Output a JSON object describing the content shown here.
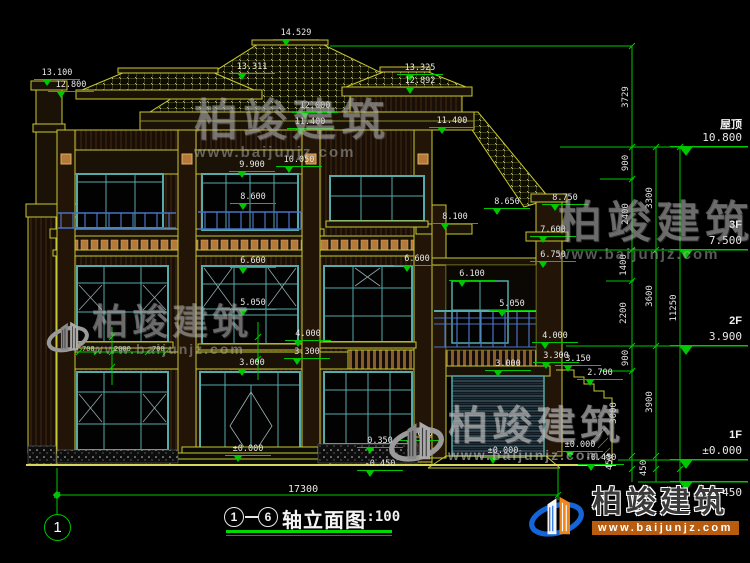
{
  "drawing": {
    "axis_start": "1",
    "axis_end": "6",
    "title": "轴立面图",
    "scale": "1:100",
    "axis_bubble": "1",
    "overall_width_dim": "17300"
  },
  "watermark": {
    "text": "柏竣建筑",
    "url": "www.baijunjz.com"
  },
  "brand": {
    "name": "柏竣建筑",
    "url": "www.baijunjz.com"
  },
  "colors": {
    "background": "#000000",
    "dim_line": "#00c800",
    "dim_text": "#e8e8e8",
    "wall_line": "#c8c832",
    "window_frame": "#55aaaa",
    "railing": "#4a72c4",
    "accent": "#b5793a",
    "brand_blue": "#1565d8",
    "brand_orange": "#f08519"
  },
  "annotations": {
    "spot_markers": [
      {
        "v": "14.529",
        "x": 296,
        "y": 33
      },
      {
        "v": "13.100",
        "x": 57,
        "y": 73
      },
      {
        "v": "12.800",
        "x": 71,
        "y": 85
      },
      {
        "v": "13.311",
        "x": 252,
        "y": 67
      },
      {
        "v": "13.325",
        "x": 420,
        "y": 68
      },
      {
        "v": "12.892",
        "x": 420,
        "y": 81
      },
      {
        "v": "12.000",
        "x": 315,
        "y": 106
      },
      {
        "v": "11.400",
        "x": 310,
        "y": 122
      },
      {
        "v": "11.400",
        "x": 452,
        "y": 121
      },
      {
        "v": "10.050",
        "x": 299,
        "y": 160
      },
      {
        "v": "9.900",
        "x": 252,
        "y": 165
      },
      {
        "v": "8.600",
        "x": 253,
        "y": 197
      },
      {
        "v": "8.650",
        "x": 507,
        "y": 202
      },
      {
        "v": "8.750",
        "x": 565,
        "y": 198
      },
      {
        "v": "8.100",
        "x": 455,
        "y": 217
      },
      {
        "v": "7.600",
        "x": 553,
        "y": 230
      },
      {
        "v": "6.750",
        "x": 553,
        "y": 255
      },
      {
        "v": "6.600",
        "x": 253,
        "y": 261
      },
      {
        "v": "6.600",
        "x": 417,
        "y": 259
      },
      {
        "v": "6.100",
        "x": 472,
        "y": 274
      },
      {
        "v": "5.050",
        "x": 253,
        "y": 303
      },
      {
        "v": "5.050",
        "x": 512,
        "y": 304
      },
      {
        "v": "4.000",
        "x": 308,
        "y": 334
      },
      {
        "v": "4.000",
        "x": 555,
        "y": 336
      },
      {
        "v": "3.300",
        "x": 307,
        "y": 352
      },
      {
        "v": "3.300",
        "x": 556,
        "y": 356
      },
      {
        "v": "3.150",
        "x": 578,
        "y": 359
      },
      {
        "v": "3.000",
        "x": 252,
        "y": 363
      },
      {
        "v": "3.000",
        "x": 508,
        "y": 364
      },
      {
        "v": "2.700",
        "x": 600,
        "y": 373
      },
      {
        "v": "0.350",
        "x": 380,
        "y": 441
      },
      {
        "v": "0.600",
        "x": 420,
        "y": 434
      },
      {
        "v": "±0.000",
        "x": 248,
        "y": 449
      },
      {
        "v": "±0.000",
        "x": 503,
        "y": 451
      },
      {
        "v": "±0.000",
        "x": 580,
        "y": 445
      },
      {
        "v": "-0.450",
        "x": 380,
        "y": 464
      },
      {
        "v": "-0.450",
        "x": 601,
        "y": 458
      }
    ],
    "chain_dims": [
      {
        "v": "3729",
        "x": 626,
        "y": 97
      },
      {
        "v": "900",
        "x": 626,
        "y": 163
      },
      {
        "v": "2400",
        "x": 626,
        "y": 214
      },
      {
        "v": "1400",
        "x": 624,
        "y": 265
      },
      {
        "v": "2200",
        "x": 624,
        "y": 313
      },
      {
        "v": "900",
        "x": 626,
        "y": 358
      },
      {
        "v": "3000",
        "x": 614,
        "y": 413
      },
      {
        "v": "450",
        "x": 610,
        "y": 462
      },
      {
        "v": "3300",
        "x": 650,
        "y": 198
      },
      {
        "v": "3600",
        "x": 650,
        "y": 296
      },
      {
        "v": "3900",
        "x": 650,
        "y": 402
      },
      {
        "v": "450",
        "x": 644,
        "y": 468
      },
      {
        "v": "11250",
        "x": 674,
        "y": 308
      }
    ],
    "floor_flags": [
      {
        "label": "屋顶",
        "value": "10.800",
        "line_y": 147,
        "below": false
      },
      {
        "label": "3F",
        "value": "7.500",
        "line_y": 250,
        "below": false
      },
      {
        "label": "2F",
        "value": "3.900",
        "line_y": 346,
        "below": false
      },
      {
        "label": "1F",
        "value": "±0.000",
        "line_y": 460,
        "below": false
      },
      {
        "label": "",
        "value": "-0.450",
        "line_y": 482,
        "below": true
      }
    ],
    "small_dims": [
      {
        "v": "700",
        "x": 82,
        "y": 345
      },
      {
        "v": "2000",
        "x": 114,
        "y": 345
      },
      {
        "v": "700",
        "x": 152,
        "y": 345
      }
    ]
  }
}
